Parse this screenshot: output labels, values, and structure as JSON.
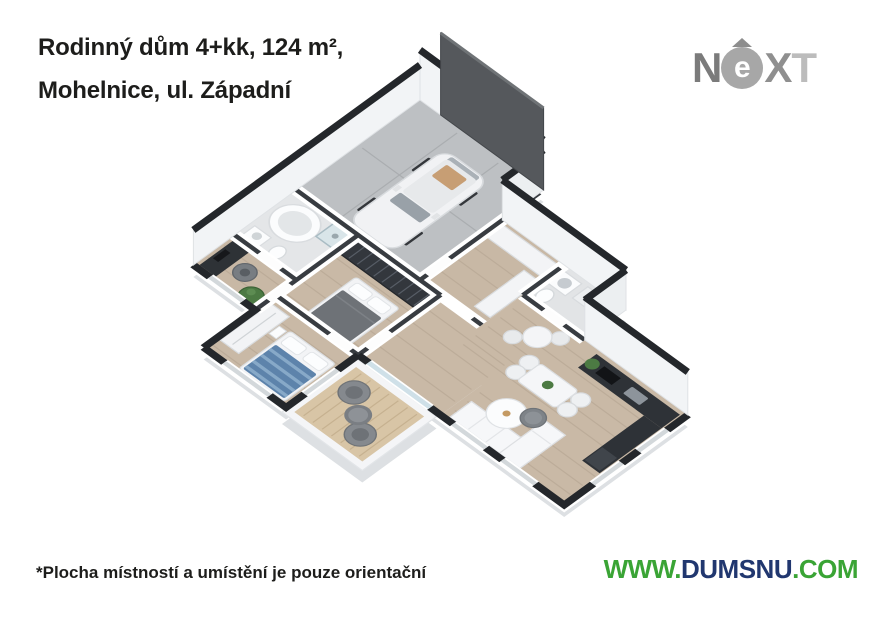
{
  "header": {
    "title_line1": "Rodinný dům 4+kk, 124 m²,",
    "title_line2": "Mohelnice, ul. Západní"
  },
  "brand": {
    "text": "NEXT",
    "n": "N",
    "e": "e",
    "x": "X",
    "t": "T"
  },
  "footer": {
    "disclaimer": "*Plocha místností a umístění je pouze orientační",
    "site_www": "WWW.",
    "site_domain": "DUMSNU",
    "site_tld": ".COM"
  },
  "colors": {
    "title_text": "#1d1d1b",
    "site_green": "#3aa435",
    "site_navy": "#21376f",
    "logo_gray_dark": "#7b7b7b",
    "logo_gray_light": "#bcbcbc",
    "wall_cap_dark": "#24272b",
    "garage_door_gray": "#55585c",
    "wood_floor": "#c9b9a6",
    "garage_floor": "#bdc0c3",
    "tile_floor": "#e4e6e8",
    "terrace_deck": "#d8c5a6",
    "kitchen_dark": "#2e3237",
    "bed_blue": "#5d83ab",
    "plant_green": "#4c7a43"
  },
  "floorplan": {
    "elements": [
      "garage",
      "car",
      "garage-door",
      "entry-hall",
      "utility-room",
      "kitchen",
      "living-room",
      "dining-table",
      "bar-table",
      "sofa",
      "coffee-table",
      "terrace",
      "terrace-armchairs",
      "master-bedroom",
      "wardrobe",
      "double-bed",
      "bathroom",
      "bathtub",
      "shower",
      "toilet",
      "home-office-desk",
      "office-chair",
      "bedroom",
      "single-bed",
      "plants"
    ]
  }
}
